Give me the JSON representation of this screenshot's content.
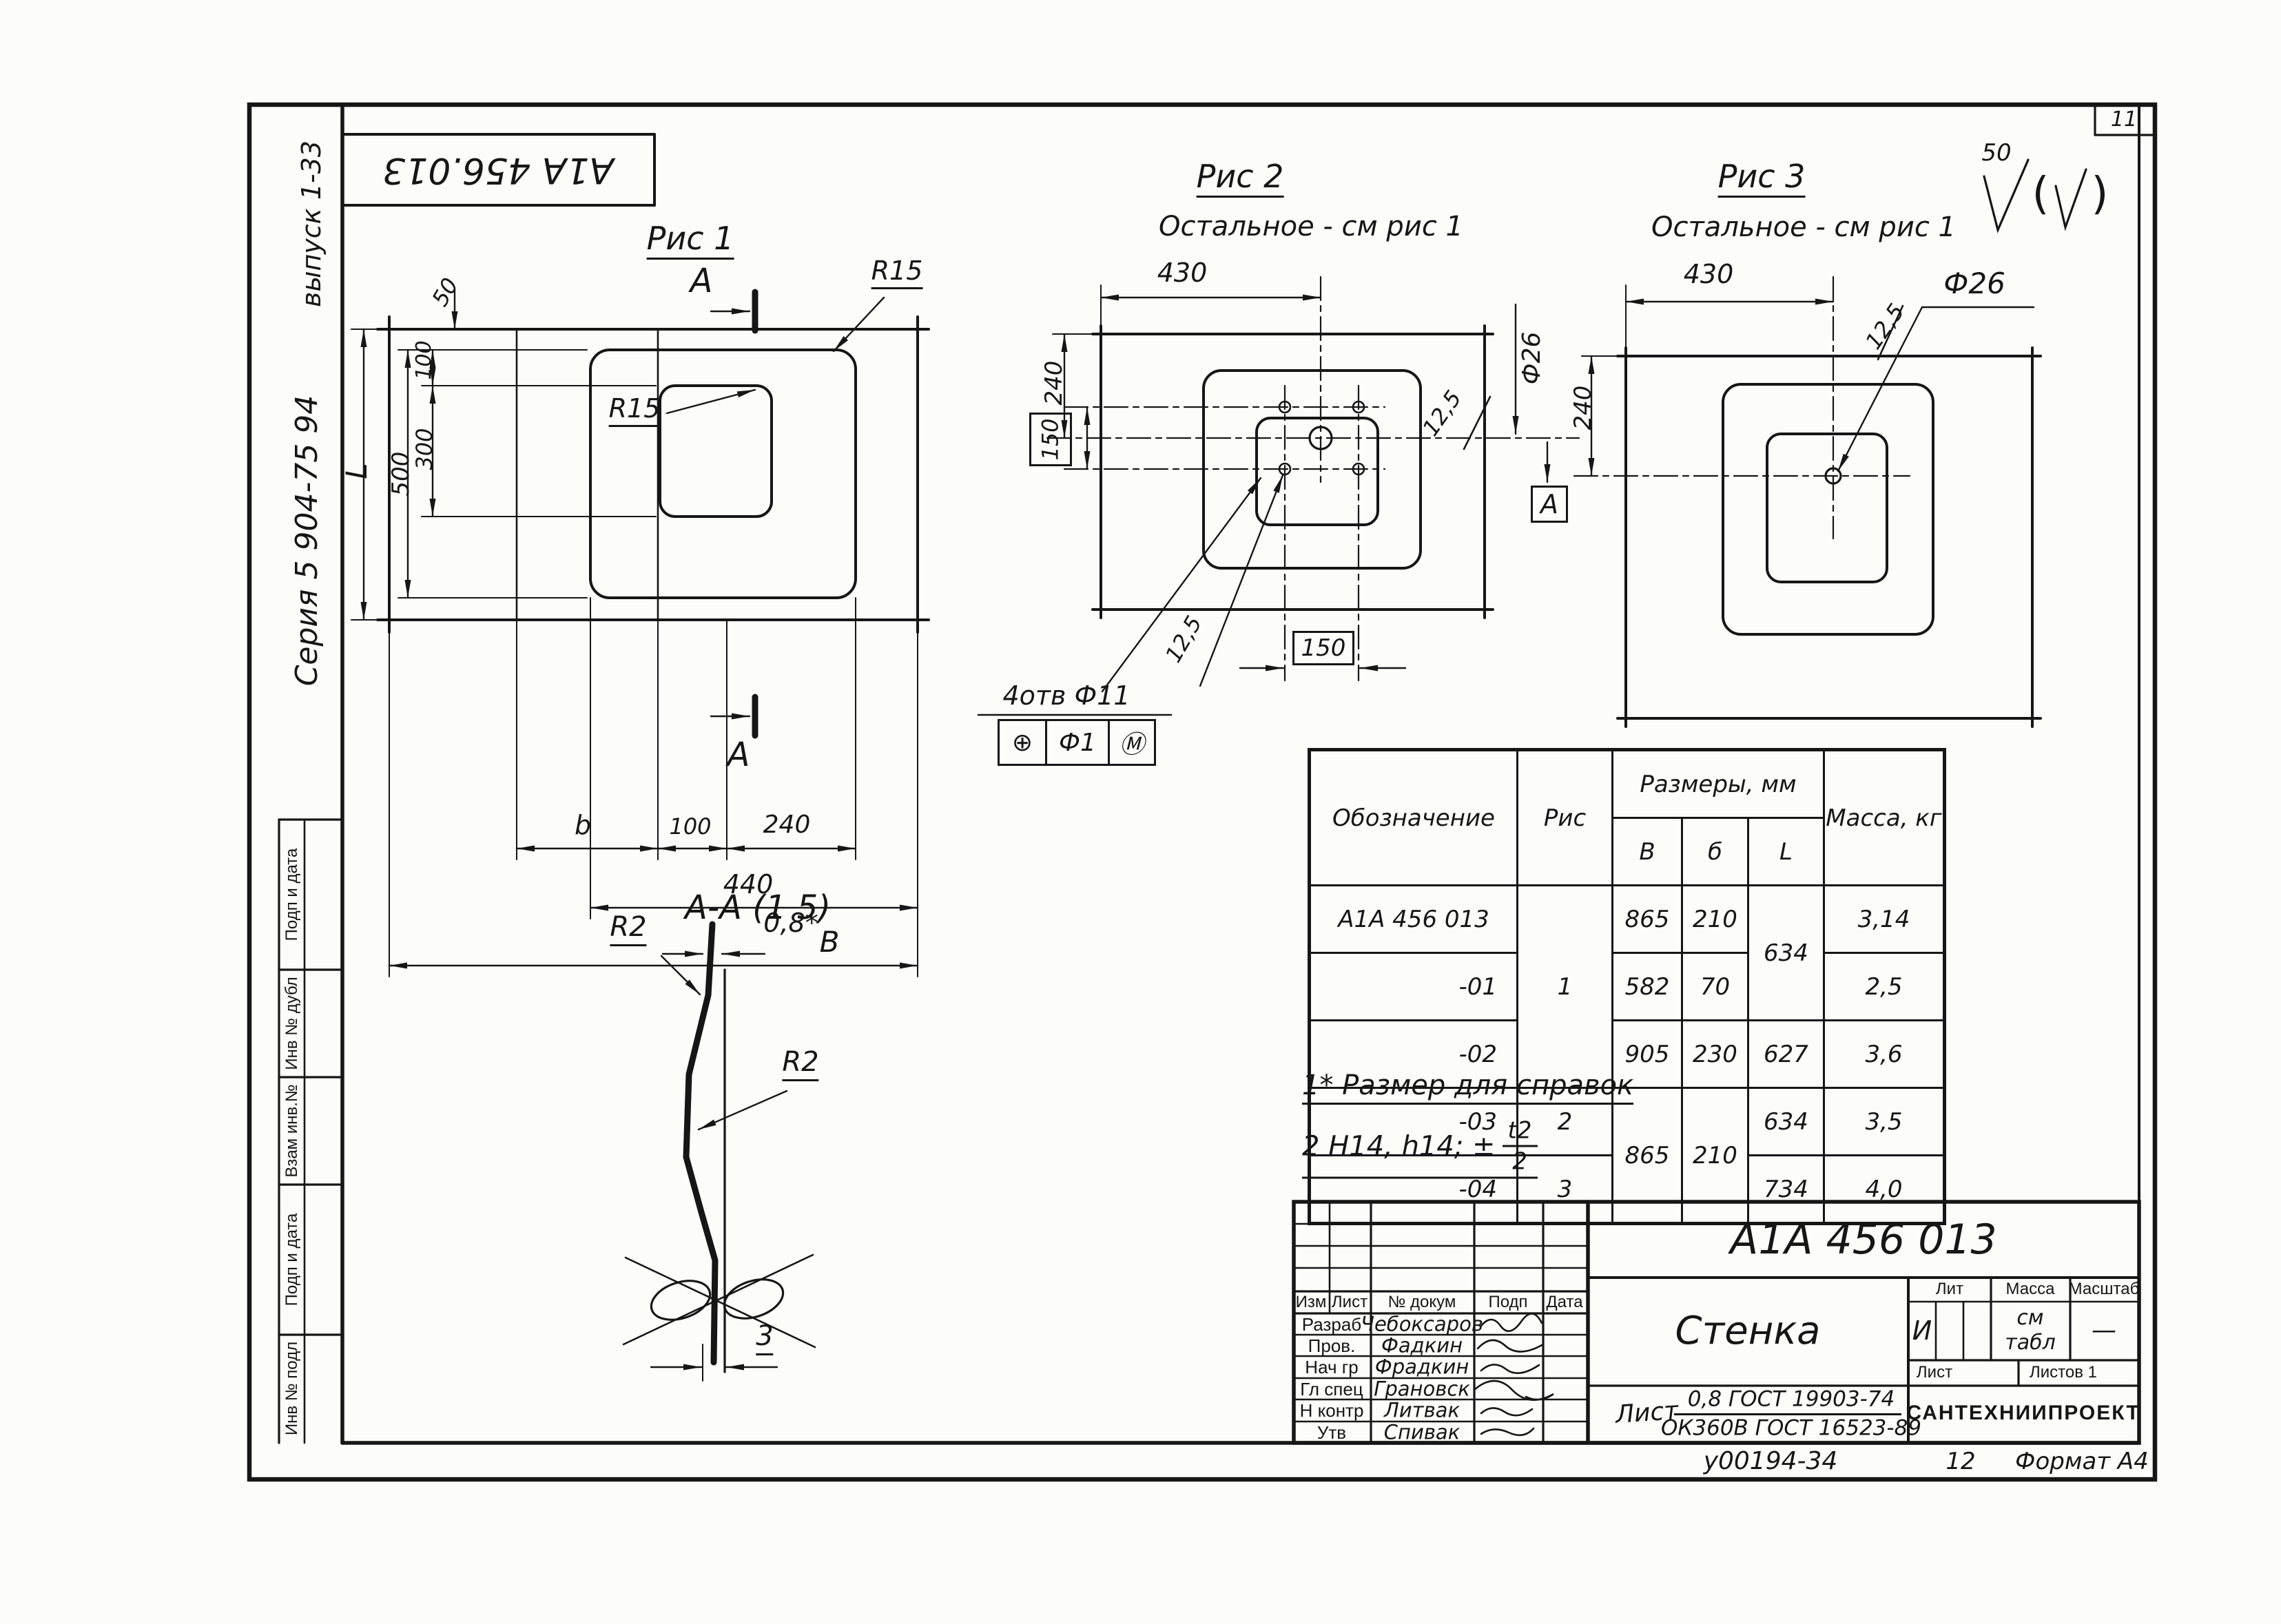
{
  "colors": {
    "ink": "#161616",
    "paper": "#fcfcf9"
  },
  "page": {
    "number": "11",
    "footer_doc": "у00194-34",
    "footer_sheet": "12",
    "footer_format": "Формат А4"
  },
  "margin": {
    "top_stamp": "А1А 456.013",
    "issue": "выпуск 1-33",
    "series": "Серия 5 904-75 94",
    "stamp_boxes": [
      "Подп и дата",
      "Инв № дубл",
      "Взам инв.№",
      "Подп и дата",
      "Инв № подл"
    ]
  },
  "finish": {
    "value": "50",
    "paren_open": "(",
    "paren_close": ")"
  },
  "fig1": {
    "title": "Рис 1",
    "section_letter": "А",
    "r15_outer": "R15",
    "r15_inner": "R15",
    "dim_50": "50",
    "dim_100_top": "100",
    "dim_300": "300",
    "dim_500": "500",
    "dim_l": "L",
    "dim_b": "b",
    "dim_100_bottom": "100",
    "dim_240": "240",
    "dim_440": "440",
    "dim_big": "B"
  },
  "fig2": {
    "title": "Рис 2",
    "subtitle": "Остальное - см рис 1",
    "dim_430": "430",
    "dim_240": "240",
    "dim_150_side": "150",
    "dim_150_bottom": "150",
    "dia": "Ф26",
    "rough_right": "12,5",
    "rough_leader": "12,5",
    "holes_note": "4отв Ф11",
    "fcf_symbol": "⊕",
    "fcf_value": "Ф1",
    "fcf_modifier": "Ⓜ",
    "section_letter": "А"
  },
  "fig3": {
    "title": "Рис 3",
    "subtitle": "Остальное - см рис 1",
    "dim_430": "430",
    "dim_240": "240",
    "dia": "Ф26",
    "rough": "12,5"
  },
  "section_aa": {
    "title": "А-А (1 5)",
    "r2_top": "R2",
    "r2_mid": "R2",
    "thickness": "0,8*",
    "dim_3": "3"
  },
  "notes": {
    "note1": "1* Размер для справок",
    "note2_prefix": "2  H14, h14; ±",
    "note2_num": "t2",
    "note2_den": "2"
  },
  "parts_table": {
    "h_designation": "Обозначение",
    "h_fig": "Рис",
    "h_dims": "Размеры, мм",
    "h_mass": "Масса, кг",
    "h_b": "В",
    "h_small_b": "б",
    "h_l": "L",
    "r1": {
      "designation": "А1А 456 013",
      "fig": "1",
      "b": "865",
      "small_b": "210",
      "l": "634",
      "mass": "3,14"
    },
    "r2": {
      "designation": "-01",
      "b": "582",
      "small_b": "70",
      "mass": "2,5"
    },
    "r3": {
      "designation": "-02",
      "b": "905",
      "small_b": "230",
      "l": "627",
      "mass": "3,6"
    },
    "r4": {
      "designation": "-03",
      "fig": "2",
      "b": "865",
      "small_b": "210",
      "l": "634",
      "mass": "3,5"
    },
    "r5": {
      "designation": "-04",
      "fig": "3",
      "l": "734",
      "mass": "4,0"
    }
  },
  "title_block": {
    "doc_number": "А1А 456 013",
    "part_name": "Стенка",
    "lit_label": "Лит",
    "mass_label": "Масса",
    "scale_label": "Масштаб",
    "lit_value": "И",
    "mass_value_line1": "см",
    "mass_value_line2": "табл",
    "scale_value": "—",
    "sheet_label": "Лист",
    "sheets_label": "Листов 1",
    "material_prefix": "Лист",
    "material_top": "0,8 ГОСТ 19903-74",
    "material_bottom": "ОК360В ГОСТ 16523-89",
    "company": "САНТЕХНИИПРОЕКТ",
    "rev_h_izm": "Изм",
    "rev_h_list": "Лист",
    "rev_h_doc": "№ докум",
    "rev_h_sign": "Подп",
    "rev_h_date": "Дата",
    "roles": [
      {
        "role": "Разраб",
        "name": "Чебоксаров"
      },
      {
        "role": "Пров.",
        "name": "Фадкин"
      },
      {
        "role": "Нач гр",
        "name": "Фрадкин"
      },
      {
        "role": "Гл спец",
        "name": "Грановск"
      },
      {
        "role": "Н контр",
        "name": "Литвак"
      },
      {
        "role": "Утв",
        "name": "Спивак"
      }
    ]
  }
}
